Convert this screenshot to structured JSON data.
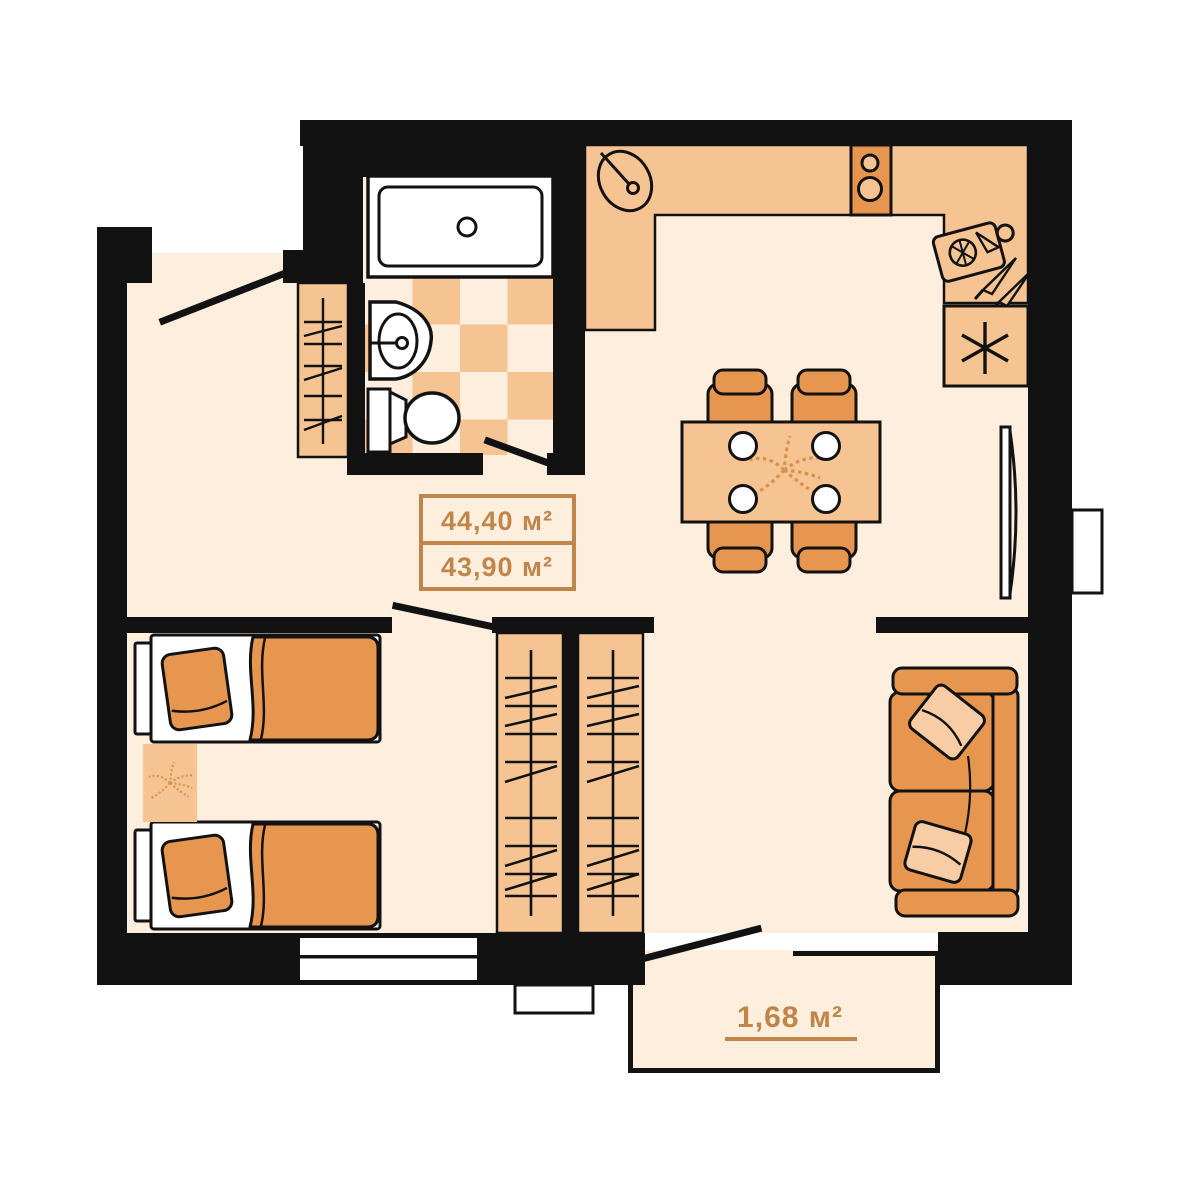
{
  "labels": {
    "area_total": "44,40 м²",
    "area_living": "43,90 м²",
    "area_balcony": "1,68 м²"
  },
  "colors": {
    "background": "#ffffff",
    "wall": "#121212",
    "floor": "#fdeedd",
    "surface_peach": "#f6c493",
    "furniture_orange": "#e6964f",
    "pillow_light": "#f8cda6",
    "decor_leaf": "#d6914b",
    "label_brown": "#c0854a",
    "fixture_white": "#ffffff"
  },
  "icons": {
    "bathtub": "rectangle-with-drain-circle",
    "wash-basin": "d-shaped-basin-with-faucet",
    "toilet": "tank-and-oval-bowl",
    "kitchen-sink": "tilted-oval-with-faucet",
    "stove": "two-burner-circles",
    "cutting-board": "board-with-wheel-and-knives",
    "fridge": "six-point-asterisk",
    "dining-table": "table-with-four-plates",
    "chair": "rounded-back-seat",
    "wardrobe": "hanging-rail-hatch",
    "bed": "mattress-pillow-blanket",
    "rug": "leaf-pattern-rect",
    "sofa": "two-seat-sofa-with-pillows",
    "tv": "wall-panel-with-arc",
    "door": "swing-line",
    "window": "double-white-line-in-wall"
  }
}
